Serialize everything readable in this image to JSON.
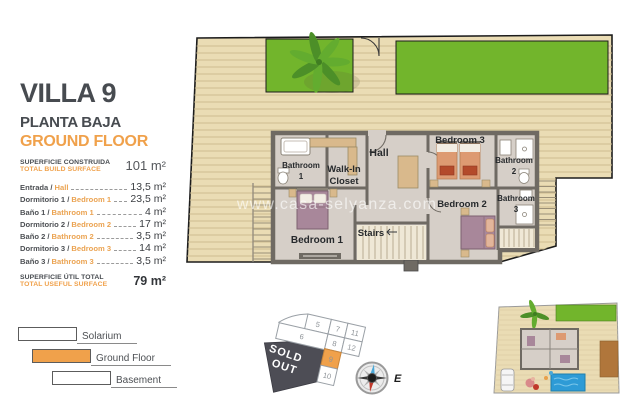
{
  "panel": {
    "title": "VILLA 9",
    "subtitle_es": "PLANTA BAJA",
    "subtitle_en": "GROUND FLOOR",
    "build_surface": {
      "label_es": "SUPERFICIE CONSTRUIDA",
      "label_en": "TOTAL BUILD SURFACE",
      "value": "101 m²"
    },
    "rooms": [
      {
        "es": "Entrada /",
        "en": "Hall",
        "value": "13,5 m²"
      },
      {
        "es": "Dormitorio 1 /",
        "en": "Bedroom 1",
        "value": "23,5 m²"
      },
      {
        "es": "Baño 1 /",
        "en": "Bathroom 1",
        "value": "4 m²"
      },
      {
        "es": "Dormitorio 2 /",
        "en": "Bedroom 2",
        "value": "17 m²"
      },
      {
        "es": "Baño 2 /",
        "en": "Bathroom 2",
        "value": "3,5 m²"
      },
      {
        "es": "Dormitorio 3 /",
        "en": "Bedroom 3",
        "value": "14 m²"
      },
      {
        "es": "Baño 3 /",
        "en": "Bathroom 3",
        "value": "3,5 m²"
      }
    ],
    "useful_surface": {
      "label_es": "SUPERFICIE ÚTIL TOTAL",
      "label_en": "TOTAL USEFUL SURFACE",
      "value": "79 m²"
    }
  },
  "legend": {
    "items": [
      {
        "label": "Solarium",
        "fill": "#FFFFFF"
      },
      {
        "label": "Ground Floor",
        "fill": "#F0A14B"
      },
      {
        "label": "Basement",
        "fill": "#FFFFFF"
      }
    ]
  },
  "floorplan": {
    "watermark": "www.casa-selyanza.com",
    "labels": {
      "hall": "Hall",
      "bathroom1_l1": "Bathroom",
      "bathroom1_l2": "1",
      "walkin_l1": "Walk-In",
      "walkin_l2": "Closet",
      "bedroom1": "Bedroom 1",
      "stairs": "Stairs",
      "bedroom2": "Bedroom 2",
      "bedroom3": "Bedroom 3",
      "bathroom2_l1": "Bathroom",
      "bathroom2_l2": "2",
      "bathroom3_l1": "Bathroom",
      "bathroom3_l2": "3"
    }
  },
  "lot_map": {
    "plots": [
      "5",
      "7",
      "11",
      "6",
      "8",
      "12",
      "9",
      "10"
    ],
    "highlighted_plot": "9",
    "sold_out": {
      "line1": "SOLD",
      "line2": "OUT"
    }
  },
  "compass": {
    "east_label": "E"
  },
  "colors": {
    "accent_orange": "#F0A14B",
    "deck": "#EADCB4",
    "lawn": "#72B52C",
    "wall_gray": "#6F6A63",
    "interior": "#D6CFC8",
    "sold_out_bg": "#4D4D55",
    "pool_blue": "#2E9BD6"
  }
}
